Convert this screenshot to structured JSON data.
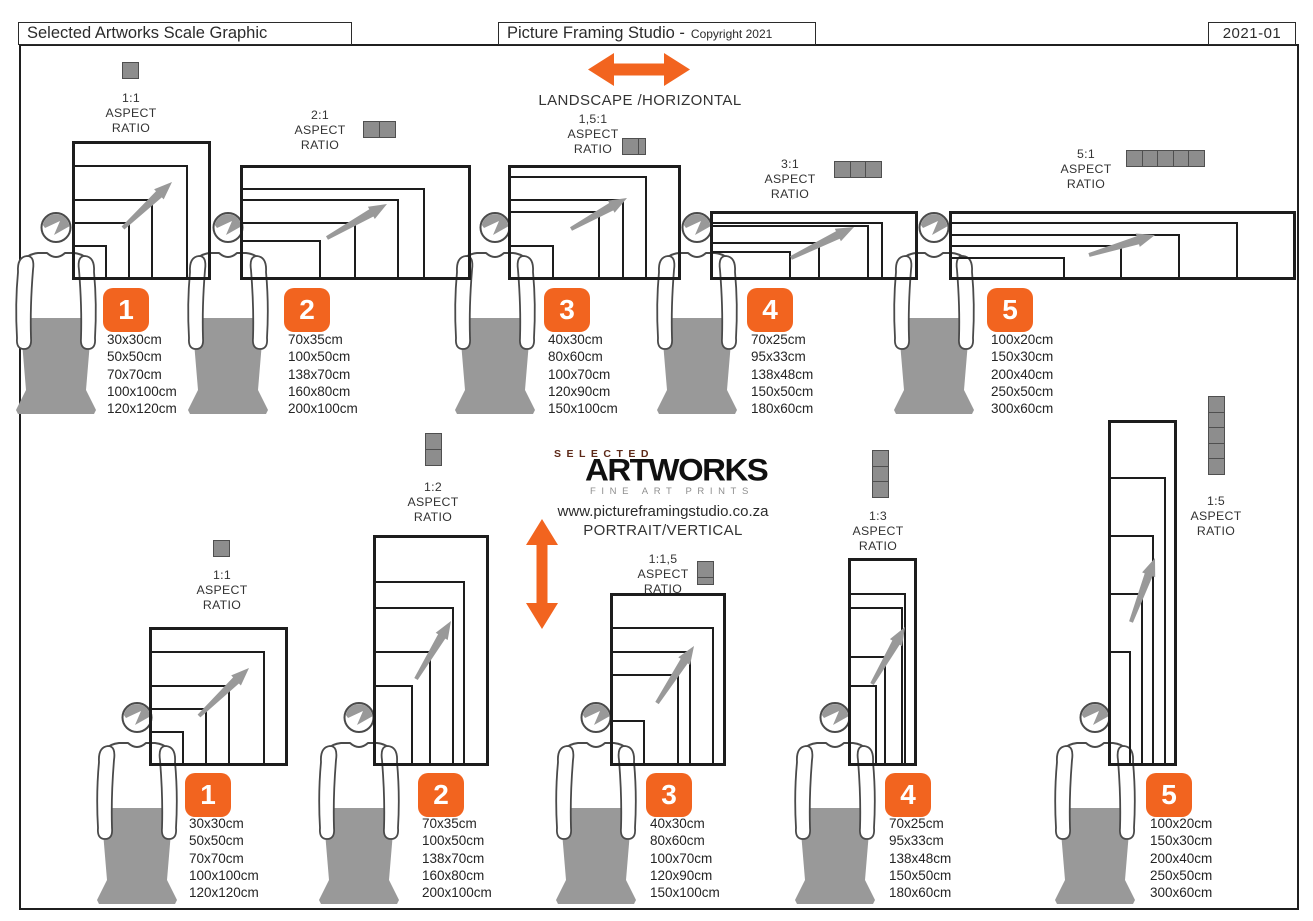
{
  "header": {
    "left_title": "Selected Artworks Scale Graphic",
    "center_title": "Picture Framing Studio -",
    "center_copyright": "Copyright 2021",
    "doc_number": "2021-01"
  },
  "orientation": {
    "landscape": "LANDSCAPE /HORIZONTAL",
    "portrait": "PORTRAIT/VERTICAL"
  },
  "logo": {
    "selected": "SELECTED",
    "artworks": "ARTWORKS",
    "tagline": "FINE ART PRINTS",
    "website": "www.pictureframingstudio.co.za"
  },
  "labels": {
    "aspect_word": "ASPECT",
    "ratio_word": "RATIO"
  },
  "colors": {
    "accent_orange": "#F2641F",
    "figure_gray": "#999999",
    "icon_gray": "#8D8D8D",
    "frame_line": "#1D1D1D"
  },
  "groups": {
    "landscape": [
      {
        "number": "1",
        "ratio": "1:1",
        "sizes": [
          "30x30cm",
          "50x50cm",
          "70x70cm",
          "100x100cm",
          "120x120cm"
        ]
      },
      {
        "number": "2",
        "ratio": "2:1",
        "sizes": [
          "70x35cm",
          "100x50cm",
          "138x70cm",
          "160x80cm",
          "200x100cm"
        ]
      },
      {
        "number": "3",
        "ratio": "1,5:1",
        "sizes": [
          "40x30cm",
          "80x60cm",
          "100x70cm",
          "120x90cm",
          "150x100cm"
        ]
      },
      {
        "number": "4",
        "ratio": "3:1",
        "sizes": [
          "70x25cm",
          "95x33cm",
          "138x48cm",
          "150x50cm",
          "180x60cm"
        ]
      },
      {
        "number": "5",
        "ratio": "5:1",
        "sizes": [
          "100x20cm",
          "150x30cm",
          "200x40cm",
          "250x50cm",
          "300x60cm"
        ]
      }
    ],
    "portrait": [
      {
        "number": "1",
        "ratio": "1:1",
        "sizes": [
          "30x30cm",
          "50x50cm",
          "70x70cm",
          "100x100cm",
          "120x120cm"
        ]
      },
      {
        "number": "2",
        "ratio": "1:2",
        "sizes": [
          "70x35cm",
          "100x50cm",
          "138x70cm",
          "160x80cm",
          "200x100cm"
        ]
      },
      {
        "number": "3",
        "ratio": "1:1,5",
        "sizes": [
          "40x30cm",
          "80x60cm",
          "100x70cm",
          "120x90cm",
          "150x100cm"
        ]
      },
      {
        "number": "4",
        "ratio": "1:3",
        "sizes": [
          "70x25cm",
          "95x33cm",
          "138x48cm",
          "150x50cm",
          "180x60cm"
        ]
      },
      {
        "number": "5",
        "ratio": "1:5",
        "sizes": [
          "100x20cm",
          "150x30cm",
          "200x40cm",
          "250x50cm",
          "300x60cm"
        ]
      }
    ]
  }
}
